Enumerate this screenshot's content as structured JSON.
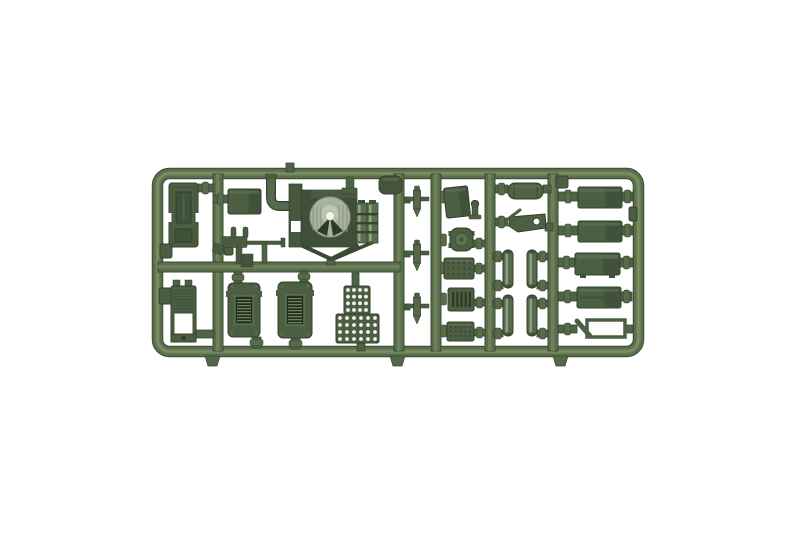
{
  "scene": {
    "description": "Olive green injection-moulded sprue of military model kit parts photographed on a plain white background",
    "background": "#ffffff"
  },
  "palette": {
    "rail": "#5a6e4e",
    "rail_light": "#6d8057",
    "rail_lighter": "#7d9065",
    "rail_dark": "#3a4932",
    "part": "#4d5f43",
    "part_shade": "#41523a",
    "part_light": "#5f7252",
    "stub": "#4f6345",
    "stub_hi": "#576b4b",
    "outline": "#31402a",
    "detail": "#2c3a26",
    "louver_bg": "#202e1b",
    "louver_line": "#6d7f5c",
    "dome": "#a8b29f",
    "dome_hi": "#c2cab8",
    "dome_dark": "#2c3a28",
    "white": "#f4f6f0"
  },
  "frame": {
    "x": 152,
    "y": 168,
    "w": 492,
    "h": 189,
    "rail": 11,
    "radius": 12
  },
  "runners": {
    "vertical": [
      218,
      399,
      436,
      490,
      553
    ],
    "width": 10,
    "y1": 174,
    "y2": 351,
    "horizontal": {
      "cy": 267,
      "x1": 158,
      "x2": 400
    }
  },
  "gate_stubs": [
    {
      "x": 205
    },
    {
      "x": 390
    },
    {
      "x": 553
    }
  ],
  "parts": [
    {
      "id": "cargo-bed",
      "type": "bed",
      "x": 169,
      "y": 183,
      "w": 29,
      "h": 64
    },
    {
      "id": "rail-box-a",
      "type": "box",
      "x": 160,
      "y": 244,
      "w": 12,
      "h": 14
    },
    {
      "id": "rail-box-b",
      "type": "box",
      "x": 159,
      "y": 288,
      "w": 14,
      "h": 16
    },
    {
      "id": "ribbed-crate",
      "type": "ribbed",
      "x": 171,
      "y": 280,
      "w": 25,
      "h": 62
    },
    {
      "id": "runner-knob",
      "type": "box",
      "x": 224,
      "y": 242,
      "w": 9,
      "h": 13
    },
    {
      "id": "engine-box",
      "type": "box3d",
      "x": 228,
      "y": 189,
      "w": 33,
      "h": 25
    },
    {
      "id": "exhaust-pipe",
      "type": "pipe",
      "x": 266,
      "y": 176
    },
    {
      "id": "machine-gun",
      "type": "gun",
      "x": 215,
      "y": 228
    },
    {
      "id": "turret-assembly",
      "type": "turret",
      "x": 289,
      "y": 184
    },
    {
      "id": "rail-hanger",
      "type": "stub2",
      "x": 344,
      "y": 177
    },
    {
      "id": "top-rail-box",
      "type": "roundbox",
      "x": 379,
      "y": 176,
      "w": 23,
      "h": 18
    },
    {
      "id": "louver-box-1",
      "type": "louverbox",
      "x": 228,
      "y": 283,
      "w": 32,
      "h": 54
    },
    {
      "id": "louver-box-2",
      "type": "louverbox",
      "x": 278,
      "y": 282,
      "w": 34,
      "h": 56
    },
    {
      "id": "ammo-crate-top",
      "type": "dotgrid",
      "x": 344,
      "y": 286,
      "w": 26,
      "h": 28,
      "cols": 4,
      "rows": 4
    },
    {
      "id": "ammo-crate-bottom",
      "type": "dotgrid",
      "x": 336,
      "y": 314,
      "w": 43,
      "h": 29,
      "cols": 6,
      "rows": 4
    },
    {
      "id": "shell-1",
      "type": "shell",
      "cx": 417,
      "y": 186
    },
    {
      "id": "shell-2",
      "type": "shell",
      "cx": 417,
      "y": 240
    },
    {
      "id": "shell-3",
      "type": "shell",
      "cx": 417,
      "y": 293
    },
    {
      "id": "tilted-box",
      "type": "box3d",
      "x": 445,
      "y": 187,
      "w": 24,
      "h": 30,
      "tilt": -6
    },
    {
      "id": "t-handle",
      "type": "thandle",
      "x": 470,
      "y": 200
    },
    {
      "id": "round-hatch",
      "type": "roundpart",
      "x": 450,
      "y": 228,
      "w": 23,
      "h": 23
    },
    {
      "id": "rivet-plate",
      "type": "rivetplate",
      "x": 444,
      "y": 258,
      "w": 30,
      "h": 21
    },
    {
      "id": "grill-plate",
      "type": "grill",
      "x": 448,
      "y": 288,
      "w": 26,
      "h": 23
    },
    {
      "id": "tread-plate",
      "type": "rivetplate",
      "x": 447,
      "y": 322,
      "w": 27,
      "h": 19
    },
    {
      "id": "muffler",
      "type": "muffler",
      "x": 508,
      "y": 183,
      "w": 35,
      "h": 16
    },
    {
      "id": "r5-top-box",
      "type": "box",
      "x": 556,
      "y": 176,
      "w": 12,
      "h": 12
    },
    {
      "id": "tool-bracket",
      "type": "bracket",
      "x": 508,
      "y": 211
    },
    {
      "id": "spring-1",
      "type": "spring",
      "x": 503,
      "y": 250,
      "w": 10,
      "h": 38
    },
    {
      "id": "spring-2",
      "type": "spring",
      "x": 527,
      "y": 250,
      "w": 10,
      "h": 38
    },
    {
      "id": "spring-3",
      "type": "spring",
      "x": 503,
      "y": 295,
      "w": 10,
      "h": 41
    },
    {
      "id": "spring-4",
      "type": "spring",
      "x": 527,
      "y": 295,
      "w": 10,
      "h": 41
    },
    {
      "id": "fuel-tank-1",
      "type": "box3d",
      "x": 578,
      "y": 187,
      "w": 44,
      "h": 21
    },
    {
      "id": "fuel-tank-2",
      "type": "box3d",
      "x": 578,
      "y": 221,
      "w": 44,
      "h": 21
    },
    {
      "id": "stowage-box-1",
      "type": "footbox",
      "x": 575,
      "y": 253,
      "w": 45,
      "h": 22
    },
    {
      "id": "stowage-box-2",
      "type": "panelbox",
      "x": 577,
      "y": 287,
      "w": 44,
      "h": 21
    },
    {
      "id": "window-frame-part",
      "type": "openbox",
      "x": 587,
      "y": 320,
      "w": 38,
      "h": 17
    },
    {
      "id": "rail-nub",
      "type": "box",
      "x": 629,
      "y": 207,
      "w": 8,
      "h": 14
    }
  ],
  "connectors": [
    {
      "x": 197,
      "y": 184,
      "w": 17,
      "h": 8,
      "o": "h",
      "b": true
    },
    {
      "x": 213,
      "y": 195,
      "w": 15,
      "h": 8,
      "o": "h",
      "b": true
    },
    {
      "x": 196,
      "y": 330,
      "w": 18,
      "h": 8,
      "o": "h",
      "b": false
    },
    {
      "x": 404,
      "y": 197,
      "w": 6,
      "h": 6,
      "o": "h",
      "b": false
    },
    {
      "x": 404,
      "y": 251,
      "w": 6,
      "h": 6,
      "o": "h",
      "b": false
    },
    {
      "x": 404,
      "y": 304,
      "w": 6,
      "h": 6,
      "o": "h",
      "b": false
    },
    {
      "x": 441,
      "y": 193,
      "w": 5,
      "h": 8,
      "o": "h",
      "b": true
    },
    {
      "x": 441,
      "y": 236,
      "w": 5,
      "h": 8,
      "o": "h",
      "b": true
    },
    {
      "x": 441,
      "y": 264,
      "w": 5,
      "h": 8,
      "o": "h",
      "b": true
    },
    {
      "x": 441,
      "y": 295,
      "w": 5,
      "h": 8,
      "o": "h",
      "b": true
    },
    {
      "x": 441,
      "y": 327,
      "w": 5,
      "h": 8,
      "o": "h",
      "b": true
    },
    {
      "x": 473,
      "y": 240,
      "w": 12,
      "h": 7,
      "o": "h",
      "b": true
    },
    {
      "x": 473,
      "y": 265,
      "w": 12,
      "h": 7,
      "o": "h",
      "b": true
    },
    {
      "x": 474,
      "y": 299,
      "w": 11,
      "h": 7,
      "o": "h",
      "b": true
    },
    {
      "x": 474,
      "y": 329,
      "w": 11,
      "h": 7,
      "o": "h",
      "b": true
    },
    {
      "x": 495,
      "y": 185,
      "w": 13,
      "h": 8,
      "o": "h",
      "b": true
    },
    {
      "x": 543,
      "y": 185,
      "w": 8,
      "h": 8,
      "o": "h",
      "b": false
    },
    {
      "x": 495,
      "y": 218,
      "w": 13,
      "h": 8,
      "o": "h",
      "b": true
    },
    {
      "x": 545,
      "y": 223,
      "w": 8,
      "h": 8,
      "o": "h",
      "b": false
    },
    {
      "x": 493,
      "y": 253,
      "w": 10,
      "h": 7,
      "o": "h",
      "b": true
    },
    {
      "x": 537,
      "y": 253,
      "w": 11,
      "h": 7,
      "o": "h",
      "b": true
    },
    {
      "x": 493,
      "y": 282,
      "w": 10,
      "h": 7,
      "o": "h",
      "b": true
    },
    {
      "x": 537,
      "y": 282,
      "w": 11,
      "h": 7,
      "o": "h",
      "b": true
    },
    {
      "x": 493,
      "y": 300,
      "w": 10,
      "h": 7,
      "o": "h",
      "b": true
    },
    {
      "x": 537,
      "y": 300,
      "w": 11,
      "h": 7,
      "o": "h",
      "b": true
    },
    {
      "x": 493,
      "y": 330,
      "w": 10,
      "h": 7,
      "o": "h",
      "b": true
    },
    {
      "x": 537,
      "y": 330,
      "w": 11,
      "h": 7,
      "o": "h",
      "b": true
    },
    {
      "x": 558,
      "y": 192,
      "w": 20,
      "h": 9,
      "o": "h",
      "b": true
    },
    {
      "x": 558,
      "y": 226,
      "w": 20,
      "h": 9,
      "o": "h",
      "b": true
    },
    {
      "x": 558,
      "y": 258,
      "w": 17,
      "h": 9,
      "o": "h",
      "b": true
    },
    {
      "x": 558,
      "y": 292,
      "w": 19,
      "h": 9,
      "o": "h",
      "b": true
    },
    {
      "x": 558,
      "y": 325,
      "w": 19,
      "h": 8,
      "o": "h",
      "b": true
    },
    {
      "x": 622,
      "y": 192,
      "w": 11,
      "h": 9,
      "o": "h",
      "b": true
    },
    {
      "x": 622,
      "y": 226,
      "w": 11,
      "h": 9,
      "o": "h",
      "b": true
    },
    {
      "x": 620,
      "y": 258,
      "w": 13,
      "h": 9,
      "o": "h",
      "b": true
    },
    {
      "x": 621,
      "y": 292,
      "w": 11,
      "h": 9,
      "o": "h",
      "b": true
    },
    {
      "x": 625,
      "y": 325,
      "w": 8,
      "h": 8,
      "o": "h",
      "b": false
    },
    {
      "x": 234,
      "y": 272,
      "w": 8,
      "h": 11,
      "o": "v",
      "b": true
    },
    {
      "x": 300,
      "y": 271,
      "w": 8,
      "h": 11,
      "o": "v",
      "b": true
    },
    {
      "x": 352,
      "y": 273,
      "w": 7,
      "h": 13,
      "o": "v",
      "b": false
    },
    {
      "x": 252,
      "y": 337,
      "w": 9,
      "h": 11,
      "o": "v",
      "b": true
    },
    {
      "x": 291,
      "y": 338,
      "w": 9,
      "h": 11,
      "o": "v",
      "b": true
    },
    {
      "x": 357,
      "y": 343,
      "w": 8,
      "h": 8,
      "o": "v",
      "b": false
    },
    {
      "x": 327,
      "y": 257,
      "w": 8,
      "h": 8,
      "o": "v",
      "b": false
    },
    {
      "x": 286,
      "y": 163,
      "w": 8,
      "h": 9,
      "o": "v",
      "b": false
    }
  ]
}
